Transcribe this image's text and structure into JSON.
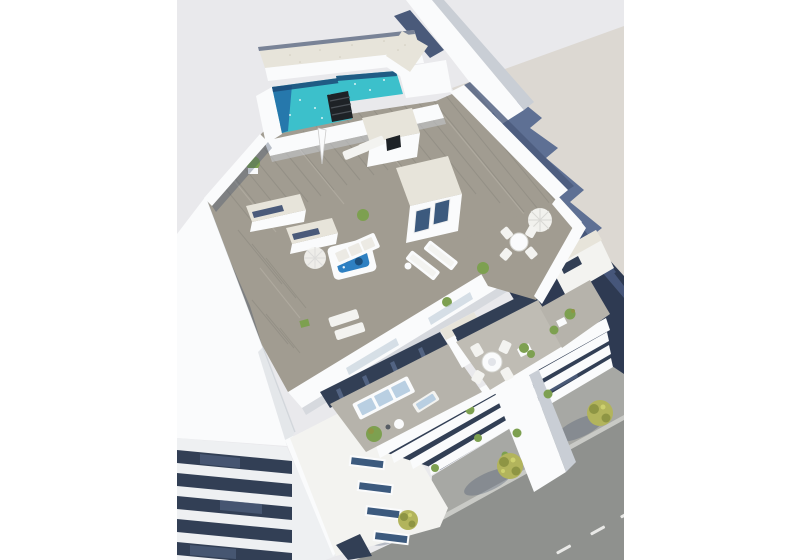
{
  "meta": {
    "description": "Aerial 3D architectural rendering of a modern white apartment building with a rooftop pool terrace, jacuzzi, sun loungers, penthouse terraces, a striped neighbouring building and a street with trees"
  },
  "scene": {
    "labels": {
      "rooftop_pool": "rooftop swimming pool",
      "secondary_pool": "secondary pool basin",
      "jacuzzi": "rooftop jacuzzi",
      "penthouse_roof": "white penthouse roof",
      "roof_deck": "timber roof deck",
      "sofa_terrace": "penthouse sofa terrace",
      "dining_terrace": "penthouse dining terrace",
      "street": "asphalt street with lane markings",
      "sidewalk": "sidewalk with trees",
      "neighbour_building": "striped neighbouring building",
      "cast_shadow": "building shadow on adjacent roof"
    }
  },
  "colors": {
    "page": "#ffffff",
    "backdrop": "#e9e9ec",
    "flat_roof": "#dcd8d2",
    "shadow_blue": "#5e7094",
    "navy_dark": "#2e3a52",
    "navy_mid": "#4a5a7a",
    "navy_stripe": "#46567a",
    "white_bright": "#fafbfc",
    "white_warm": "#f3f3f0",
    "wall_shade": "#c9ced5",
    "wall_shade2": "#b6bdc6",
    "slab_white": "#eef0f2",
    "gravel": "#e7e4da",
    "gravel_dot": "#cfcabc",
    "deck": "#a19c91",
    "deck_dark": "#85827a",
    "deck_light": "#b7b2a6",
    "tile": "#b6b3ab",
    "tile2": "#bfbcb4",
    "pool_teal": "#3cc0cb",
    "pool_deep": "#2470a8",
    "pool_navy": "#1b4a78",
    "jacuzzi": "#2e80c2",
    "jacuzzi_seat": "#1c4f7d",
    "glass_dark": "#323f55",
    "glass_mid": "#5a6d8e",
    "glass_win": "#3c5a7e",
    "glass_light": "#c9d5df",
    "asphalt": "#8f918e",
    "sidewalk": "#a7a8a4",
    "curb": "#c9cac6",
    "lane": "#e9e9e7",
    "tree": "#b2b45c",
    "tree_dark": "#8e9544",
    "tree_light": "#cdd06e",
    "plant": "#7da050",
    "black_box": "#1e2226",
    "cushion": "#b9cfe2",
    "edge_line": "#d6dade",
    "shadow_soft": "#3d4c66"
  }
}
